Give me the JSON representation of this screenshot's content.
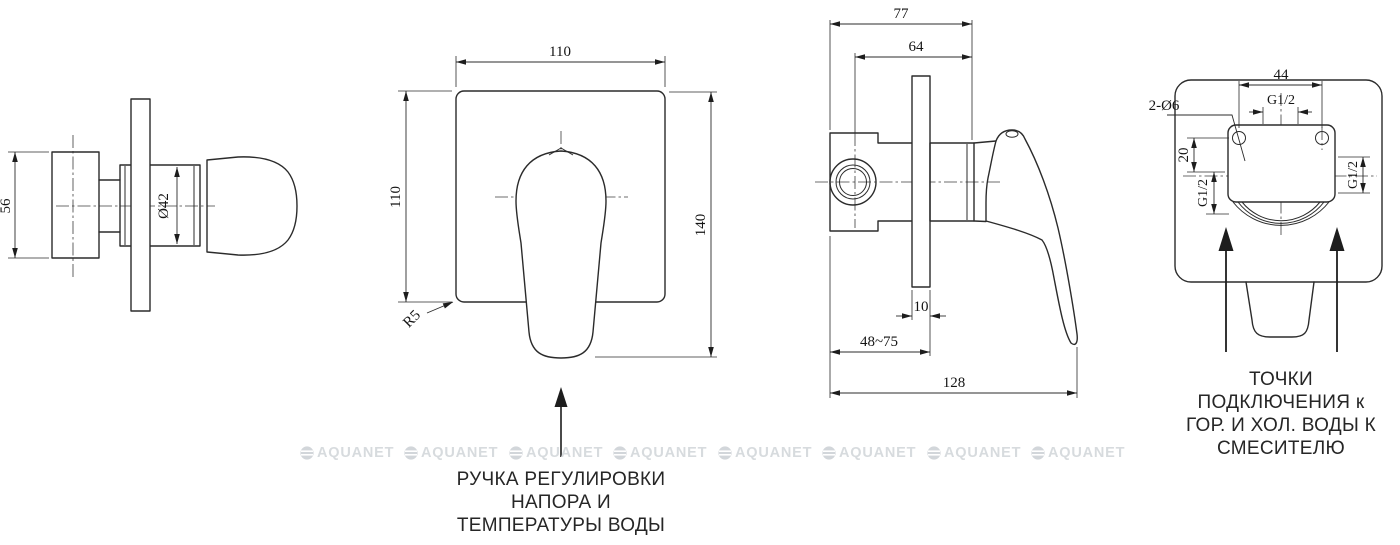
{
  "drawing": {
    "view1": {
      "dim_height": "56",
      "dim_diameter": "Ø42"
    },
    "view2": {
      "dim_width": "110",
      "dim_height": "110",
      "dim_total_height": "140",
      "dim_corner_radius": "R5",
      "callout": {
        "lines": [
          "РУЧКА РЕГУЛИРОВКИ",
          "НАПОРА И",
          "ТЕМПЕРАТУРЫ ВОДЫ"
        ]
      }
    },
    "view3": {
      "dim_depth_full": "77",
      "dim_depth_body": "64",
      "dim_plate_thickness": "10",
      "dim_mount_range": "48~75",
      "dim_length": "128"
    },
    "view4": {
      "dim_hole_spacing": "44",
      "dim_thread_top": "G1/2",
      "dim_holes": "2-Ø6",
      "dim_offset": "20",
      "dim_thread_left": "G1/2",
      "dim_thread_right": "G1/2",
      "callout": {
        "lines": [
          "ТОЧКИ",
          "ПОДКЛЮЧЕНИЯ к",
          "ГОР. И ХОЛ. ВОДЫ К",
          "СМЕСИТЕЛЮ"
        ]
      }
    },
    "watermark": {
      "text": "AQUANET"
    }
  }
}
